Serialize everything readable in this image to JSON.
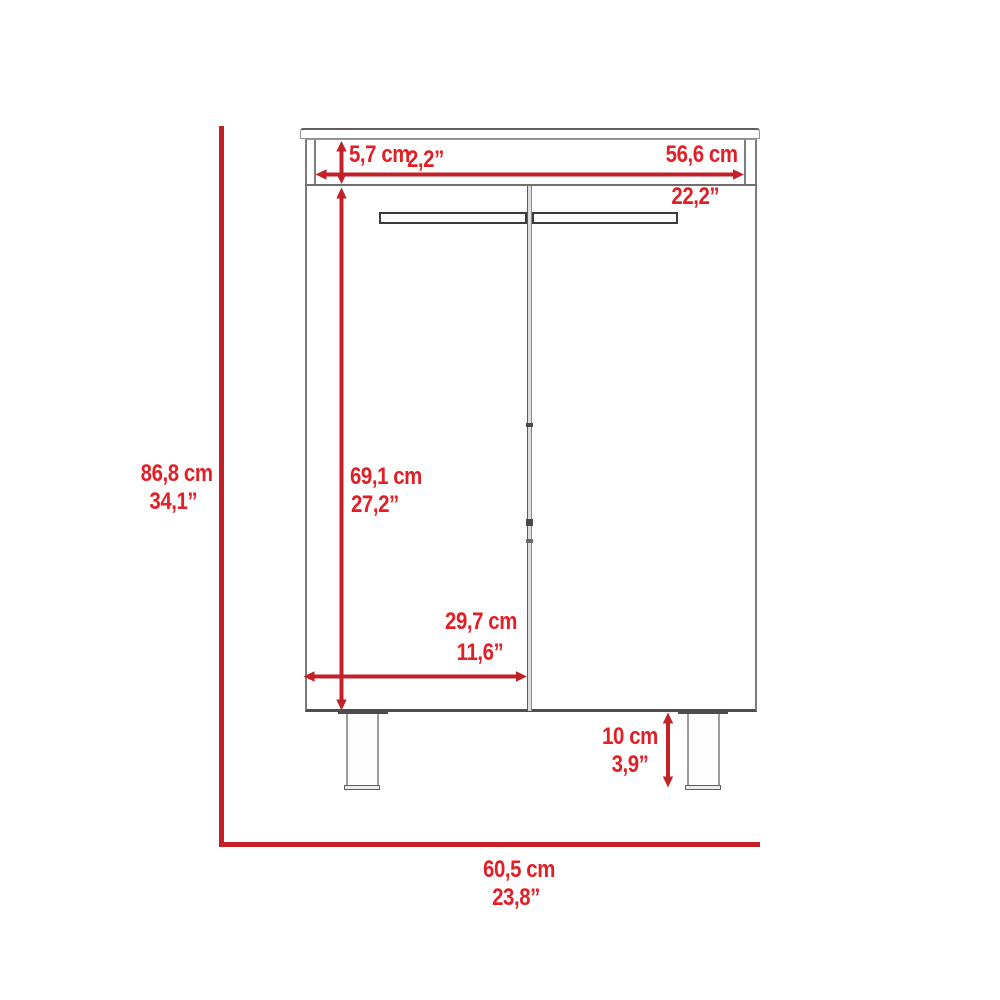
{
  "diagram": {
    "title": "Two-door cabinet front elevation with dimensions",
    "accent_color": "#c32127",
    "outline_color": "#6e6e6e",
    "dimensions": {
      "overall_height": {
        "cm": "86,8 cm",
        "inches": "34,1”"
      },
      "top_frame_height": {
        "cm": "5,7 cm",
        "inches": "2,2”"
      },
      "interior_width": {
        "cm": "56,6 cm",
        "inches": "22,2”"
      },
      "door_height": {
        "cm": "69,1 cm",
        "inches": "27,2”"
      },
      "door_width": {
        "cm": "29,7 cm",
        "inches": "11,6”"
      },
      "leg_height": {
        "cm": "10 cm",
        "inches": "3,9”"
      },
      "overall_width": {
        "cm": "60,5 cm",
        "inches": "23,8”"
      }
    }
  }
}
